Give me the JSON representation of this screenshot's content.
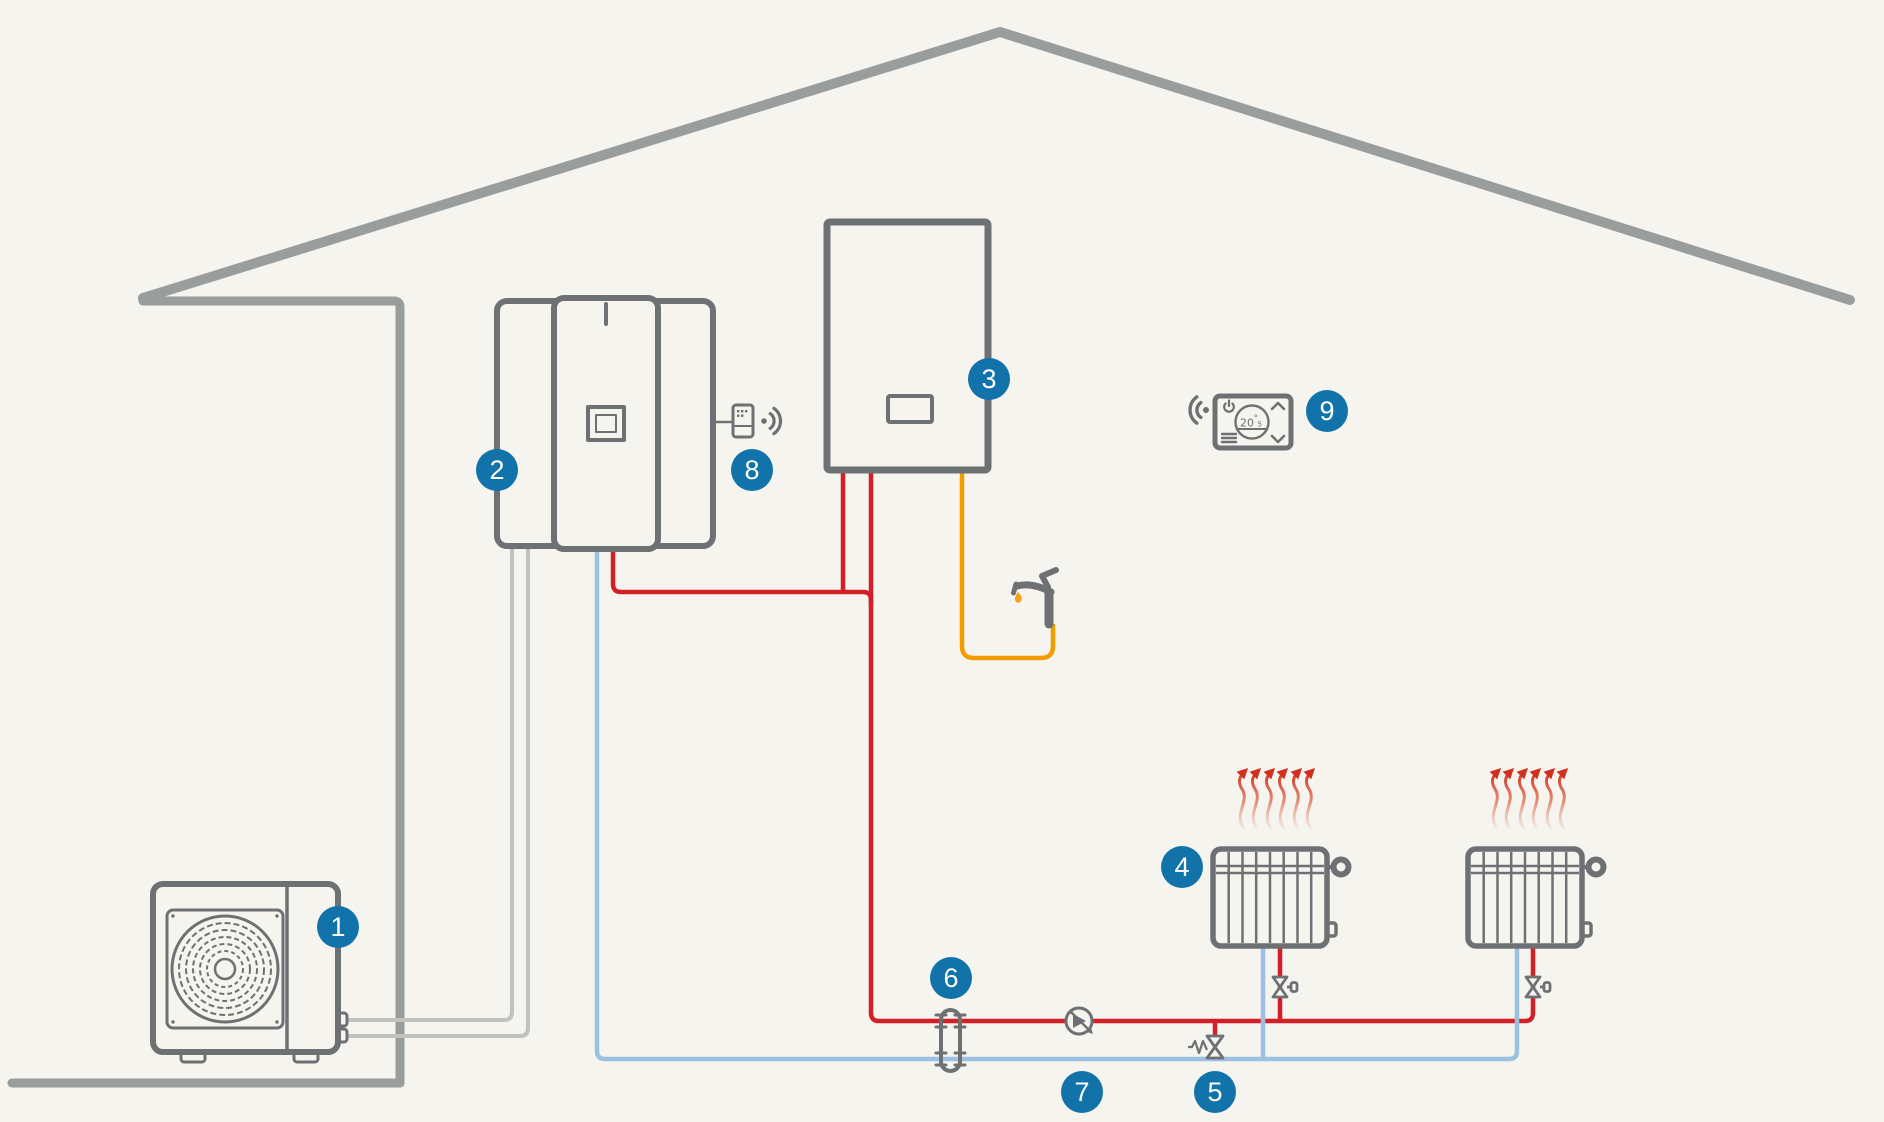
{
  "badges": [
    {
      "label": "1"
    },
    {
      "label": "2"
    },
    {
      "label": "3"
    },
    {
      "label": "4"
    },
    {
      "label": "5"
    },
    {
      "label": "6"
    },
    {
      "label": "7"
    },
    {
      "label": "8"
    },
    {
      "label": "9"
    }
  ],
  "thermostat": {
    "value": "20",
    "degree": "°",
    "decimal": "5"
  },
  "colors": {
    "background": "#f5f4ef",
    "badge_blue": "#1173a9",
    "pipe_red": "#d32028",
    "pipe_blue": "#9cc0e0",
    "pipe_orange": "#f49b00",
    "refrigerant_gray": "#c0c2c1",
    "outline_dark_gray": "#6e7173",
    "house_gray": "#999d9c",
    "heat_wave_red": "#d2301f",
    "drop_orange": "#f4a11c"
  },
  "icons": {
    "heat_pump_fan": "concentric-fan-grille",
    "wifi_waves": "radio-arcs-with-dot",
    "faucet": "tap-with-water-drop",
    "heat_waves": "rising-red-heat-arrows",
    "pump": "circle-with-flow-triangle",
    "radiator_valve": "bowtie-valve-with-port",
    "overflow_valve": "spring-bowtie-valve",
    "hydraulic_separator": "capsule-coupler",
    "power": "power-symbol",
    "menu": "hamburger-lines",
    "chevron_up": "^",
    "chevron_down": "v"
  }
}
